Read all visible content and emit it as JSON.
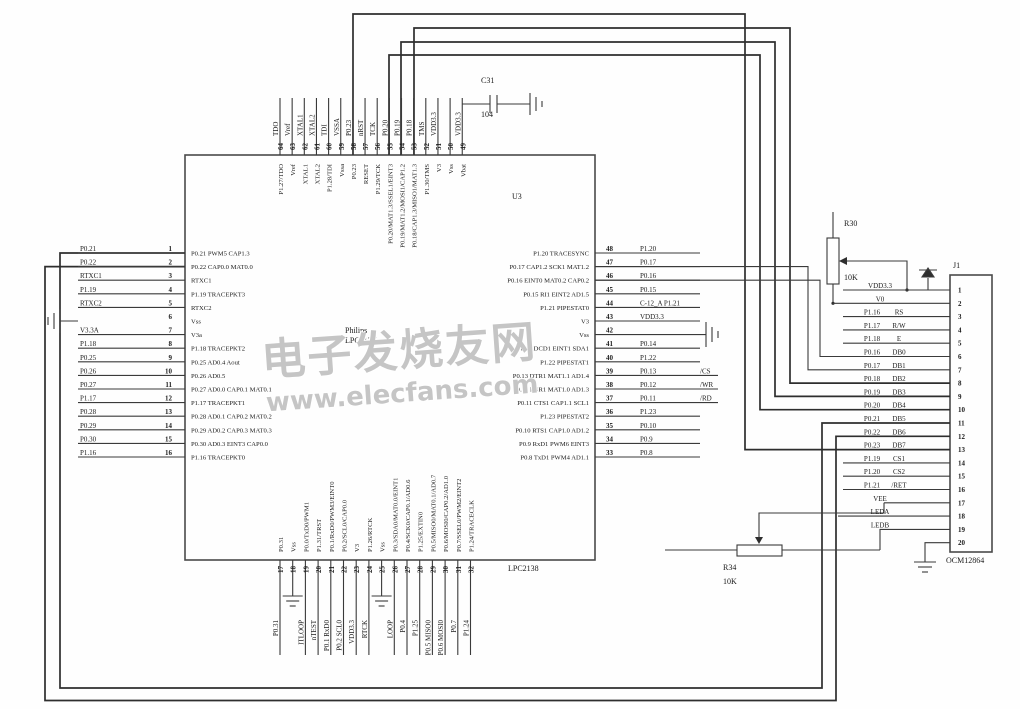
{
  "watermark": {
    "line1": "电子发烧友网",
    "line2": "www.elecfans.com"
  },
  "chip": {
    "designator": "U3",
    "maker": "Philips",
    "family": "LPC213X",
    "part": "LPC2138",
    "left_pins": [
      {
        "num": 1,
        "net": "P0.21",
        "func": "P0.21 PWM5 CAP1.3"
      },
      {
        "num": 2,
        "net": "P0.22",
        "func": "P0.22 CAP0.0 MAT0.0"
      },
      {
        "num": 3,
        "net": "RTXC1",
        "func": "RTXC1"
      },
      {
        "num": 4,
        "net": "P1.19",
        "func": "P1.19 TRACEPKT3"
      },
      {
        "num": 5,
        "net": "RTXC2",
        "func": "RTXC2"
      },
      {
        "num": 6,
        "net": "",
        "gnd": true,
        "func": "Vss"
      },
      {
        "num": 7,
        "net": "V3.3A",
        "func": "V3a"
      },
      {
        "num": 8,
        "net": "P1.18",
        "func": "P1.18 TRACEPKT2"
      },
      {
        "num": 9,
        "net": "P0.25",
        "func": "P0.25 AD0.4 Aout"
      },
      {
        "num": 10,
        "net": "P0.26",
        "func": "P0.26 AD0.5"
      },
      {
        "num": 11,
        "net": "P0.27",
        "func": "P0.27 AD0.0 CAP0.1 MAT0.1"
      },
      {
        "num": 12,
        "net": "P1.17",
        "func": "P1.17 TRACEPKT1"
      },
      {
        "num": 13,
        "net": "P0.28",
        "func": "P0.28 AD0.1 CAP0.2 MAT0.2"
      },
      {
        "num": 14,
        "net": "P0.29",
        "func": "P0.29 AD0.2 CAP0.3 MAT0.3"
      },
      {
        "num": 15,
        "net": "P0.30",
        "func": "P0.30 AD0.3 EINT3 CAP0.0"
      },
      {
        "num": 16,
        "net": "P1.16",
        "func": "P1.16 TRACEPKT0"
      }
    ],
    "right_pins": [
      {
        "num": 48,
        "net": "P1.20",
        "func": "P1.20 TRACESYNC"
      },
      {
        "num": 47,
        "net": "P0.17",
        "func": "P0.17 CAP1.2 SCK1 MAT1.2"
      },
      {
        "num": 46,
        "net": "P0.16",
        "func": "P0.16 EINT0 MAT0.2 CAP0.2"
      },
      {
        "num": 45,
        "net": "P0.15",
        "func": "P0.15 RI1 EINT2 AD1.5"
      },
      {
        "num": 44,
        "net": "C-12_A P1.21",
        "func": "P1.21 PIPESTAT0"
      },
      {
        "num": 43,
        "net": "VDD3.3",
        "func": "V3"
      },
      {
        "num": 42,
        "net": "",
        "gnd": true,
        "func": "Vss"
      },
      {
        "num": 41,
        "net": "P0.14",
        "func": "P0.14 DCD1 EINT1 SDA1"
      },
      {
        "num": 40,
        "net": "P1.22",
        "func": "P1.22 PIPESTAT1"
      },
      {
        "num": 39,
        "net": "P0.13",
        "tag": "/CS",
        "func": "P0.13 DTR1 MAT1.1 AD1.4"
      },
      {
        "num": 38,
        "net": "P0.12",
        "tag": "/WR",
        "func": "P0.12 DSR1 MAT1.0 AD1.3"
      },
      {
        "num": 37,
        "net": "P0.11",
        "tag": "/RD",
        "func": "P0.11 CTS1 CAP1.1 SCL1"
      },
      {
        "num": 36,
        "net": "P1.23",
        "func": "P1.23 PIPESTAT2"
      },
      {
        "num": 35,
        "net": "P0.10",
        "func": "P0.10 RTS1 CAP1.0 AD1.2"
      },
      {
        "num": 34,
        "net": "P0.9",
        "func": "P0.9 RxD1 PWM6 EINT3"
      },
      {
        "num": 33,
        "net": "P0.8",
        "func": "P0.8 TxD1 PWM4 AD1.1"
      }
    ],
    "top_pins": [
      {
        "num": 64,
        "net": "TDO",
        "func": "P1.27/TDO"
      },
      {
        "num": 63,
        "net": "Vref",
        "func": "Vref"
      },
      {
        "num": 62,
        "net": "XTAL1",
        "func": "XTAL1"
      },
      {
        "num": 61,
        "net": "XTAL2",
        "func": "XTAL2"
      },
      {
        "num": 60,
        "net": "TDI",
        "func": "P1.28/TDI"
      },
      {
        "num": 59,
        "net": "VSSA",
        "func": "Vssa"
      },
      {
        "num": 58,
        "net": "P0.23",
        "func": "P0.23"
      },
      {
        "num": 57,
        "net": "nRST",
        "func": "RESET"
      },
      {
        "num": 56,
        "net": "TCK",
        "func": "P1.29/TCK"
      },
      {
        "num": 55,
        "net": "P0.20",
        "func": "P0.20/MAT1.3/SSEL1/EINT3"
      },
      {
        "num": 54,
        "net": "P0.19",
        "func": "P0.19/MAT1.2/MOSI1/CAP1.2"
      },
      {
        "num": 53,
        "net": "P0.18",
        "func": "P0.18/CAP1.3/MISO1/MAT1.3"
      },
      {
        "num": 52,
        "net": "TMS",
        "func": "P1.30/TMS"
      },
      {
        "num": 51,
        "net": "VDD3.3",
        "func": "V3"
      },
      {
        "num": 50,
        "net": "",
        "thick": true,
        "func": "Vss"
      },
      {
        "num": 49,
        "net": "VDD3.3",
        "func": "Vbat"
      }
    ],
    "bottom_pins": [
      {
        "num": 17,
        "net": "P0.31",
        "func": "P0.31"
      },
      {
        "num": 18,
        "net": "",
        "gnd": true,
        "func": "Vss"
      },
      {
        "num": 19,
        "net": "ITLOOP",
        "func": "P0.0/TxD0/PWM1"
      },
      {
        "num": 20,
        "net": "nTEST",
        "func": "P1.31/TRST"
      },
      {
        "num": 21,
        "net": "P0.1 RxD0",
        "func": "P0.1/RxD0/PWM3/EINT0"
      },
      {
        "num": 22,
        "net": "P0.2 SCL0",
        "func": "P0.2/SCL0/CAP0.0"
      },
      {
        "num": 23,
        "net": "VDD3.3",
        "func": "V3"
      },
      {
        "num": 24,
        "net": "RTCK",
        "func": "P1.26/RTCK"
      },
      {
        "num": 25,
        "net": "",
        "gnd": true,
        "func": "Vss"
      },
      {
        "num": 26,
        "net": "LOOP",
        "func": "P0.3/SDA0/MAT0.0/EINT1"
      },
      {
        "num": 27,
        "net": "P0.4",
        "func": "P0.4/SCK0/CAP0.1/AD0.6"
      },
      {
        "num": 28,
        "net": "P1.25",
        "func": "P1.25/EXTIN0"
      },
      {
        "num": 29,
        "net": "P0.5 MISO0",
        "func": "P0.5/MISO0/MAT0.1/AD0.7"
      },
      {
        "num": 30,
        "net": "P0.6 MOSI0",
        "func": "P0.6/MOSI0/CAP0.2/AD1.0"
      },
      {
        "num": 31,
        "net": "P0.7",
        "func": "P0.7/SSEL0/PWM2/EINT2"
      },
      {
        "num": 32,
        "net": "P1.24",
        "func": "P1.24/TRACECLK"
      }
    ]
  },
  "connector": {
    "designator": "J1",
    "part": "OCM12864",
    "pins": [
      {
        "num": 1,
        "net": "",
        "func": "VDD3.3"
      },
      {
        "num": 2,
        "net": "",
        "func": "V0"
      },
      {
        "num": 3,
        "net": "P1.16",
        "func": "RS"
      },
      {
        "num": 4,
        "net": "P1.17",
        "func": "R/W"
      },
      {
        "num": 5,
        "net": "P1.18",
        "func": "E"
      },
      {
        "num": 6,
        "net": "P0.16",
        "func": "DB0"
      },
      {
        "num": 7,
        "net": "P0.17",
        "func": "DB1"
      },
      {
        "num": 8,
        "net": "P0.18",
        "func": "DB2"
      },
      {
        "num": 9,
        "net": "P0.19",
        "func": "DB3"
      },
      {
        "num": 10,
        "net": "P0.20",
        "func": "DB4"
      },
      {
        "num": 11,
        "net": "P0.21",
        "func": "DB5"
      },
      {
        "num": 12,
        "net": "P0.22",
        "func": "DB6"
      },
      {
        "num": 13,
        "net": "P0.23",
        "func": "DB7"
      },
      {
        "num": 14,
        "net": "P1.19",
        "func": "CS1"
      },
      {
        "num": 15,
        "net": "P1.20",
        "func": "CS2"
      },
      {
        "num": 16,
        "net": "P1.21",
        "func": "/RET"
      },
      {
        "num": 17,
        "net": "",
        "func": "VEE"
      },
      {
        "num": 18,
        "net": "",
        "func": "LEDA"
      },
      {
        "num": 19,
        "net": "",
        "func": "LEDB"
      },
      {
        "num": 20,
        "net": "",
        "func": ""
      }
    ]
  },
  "components": {
    "c31": {
      "ref": "C31",
      "value": "104"
    },
    "r30": {
      "ref": "R30",
      "value": "10K"
    },
    "r34": {
      "ref": "R34",
      "value": "10K"
    }
  }
}
